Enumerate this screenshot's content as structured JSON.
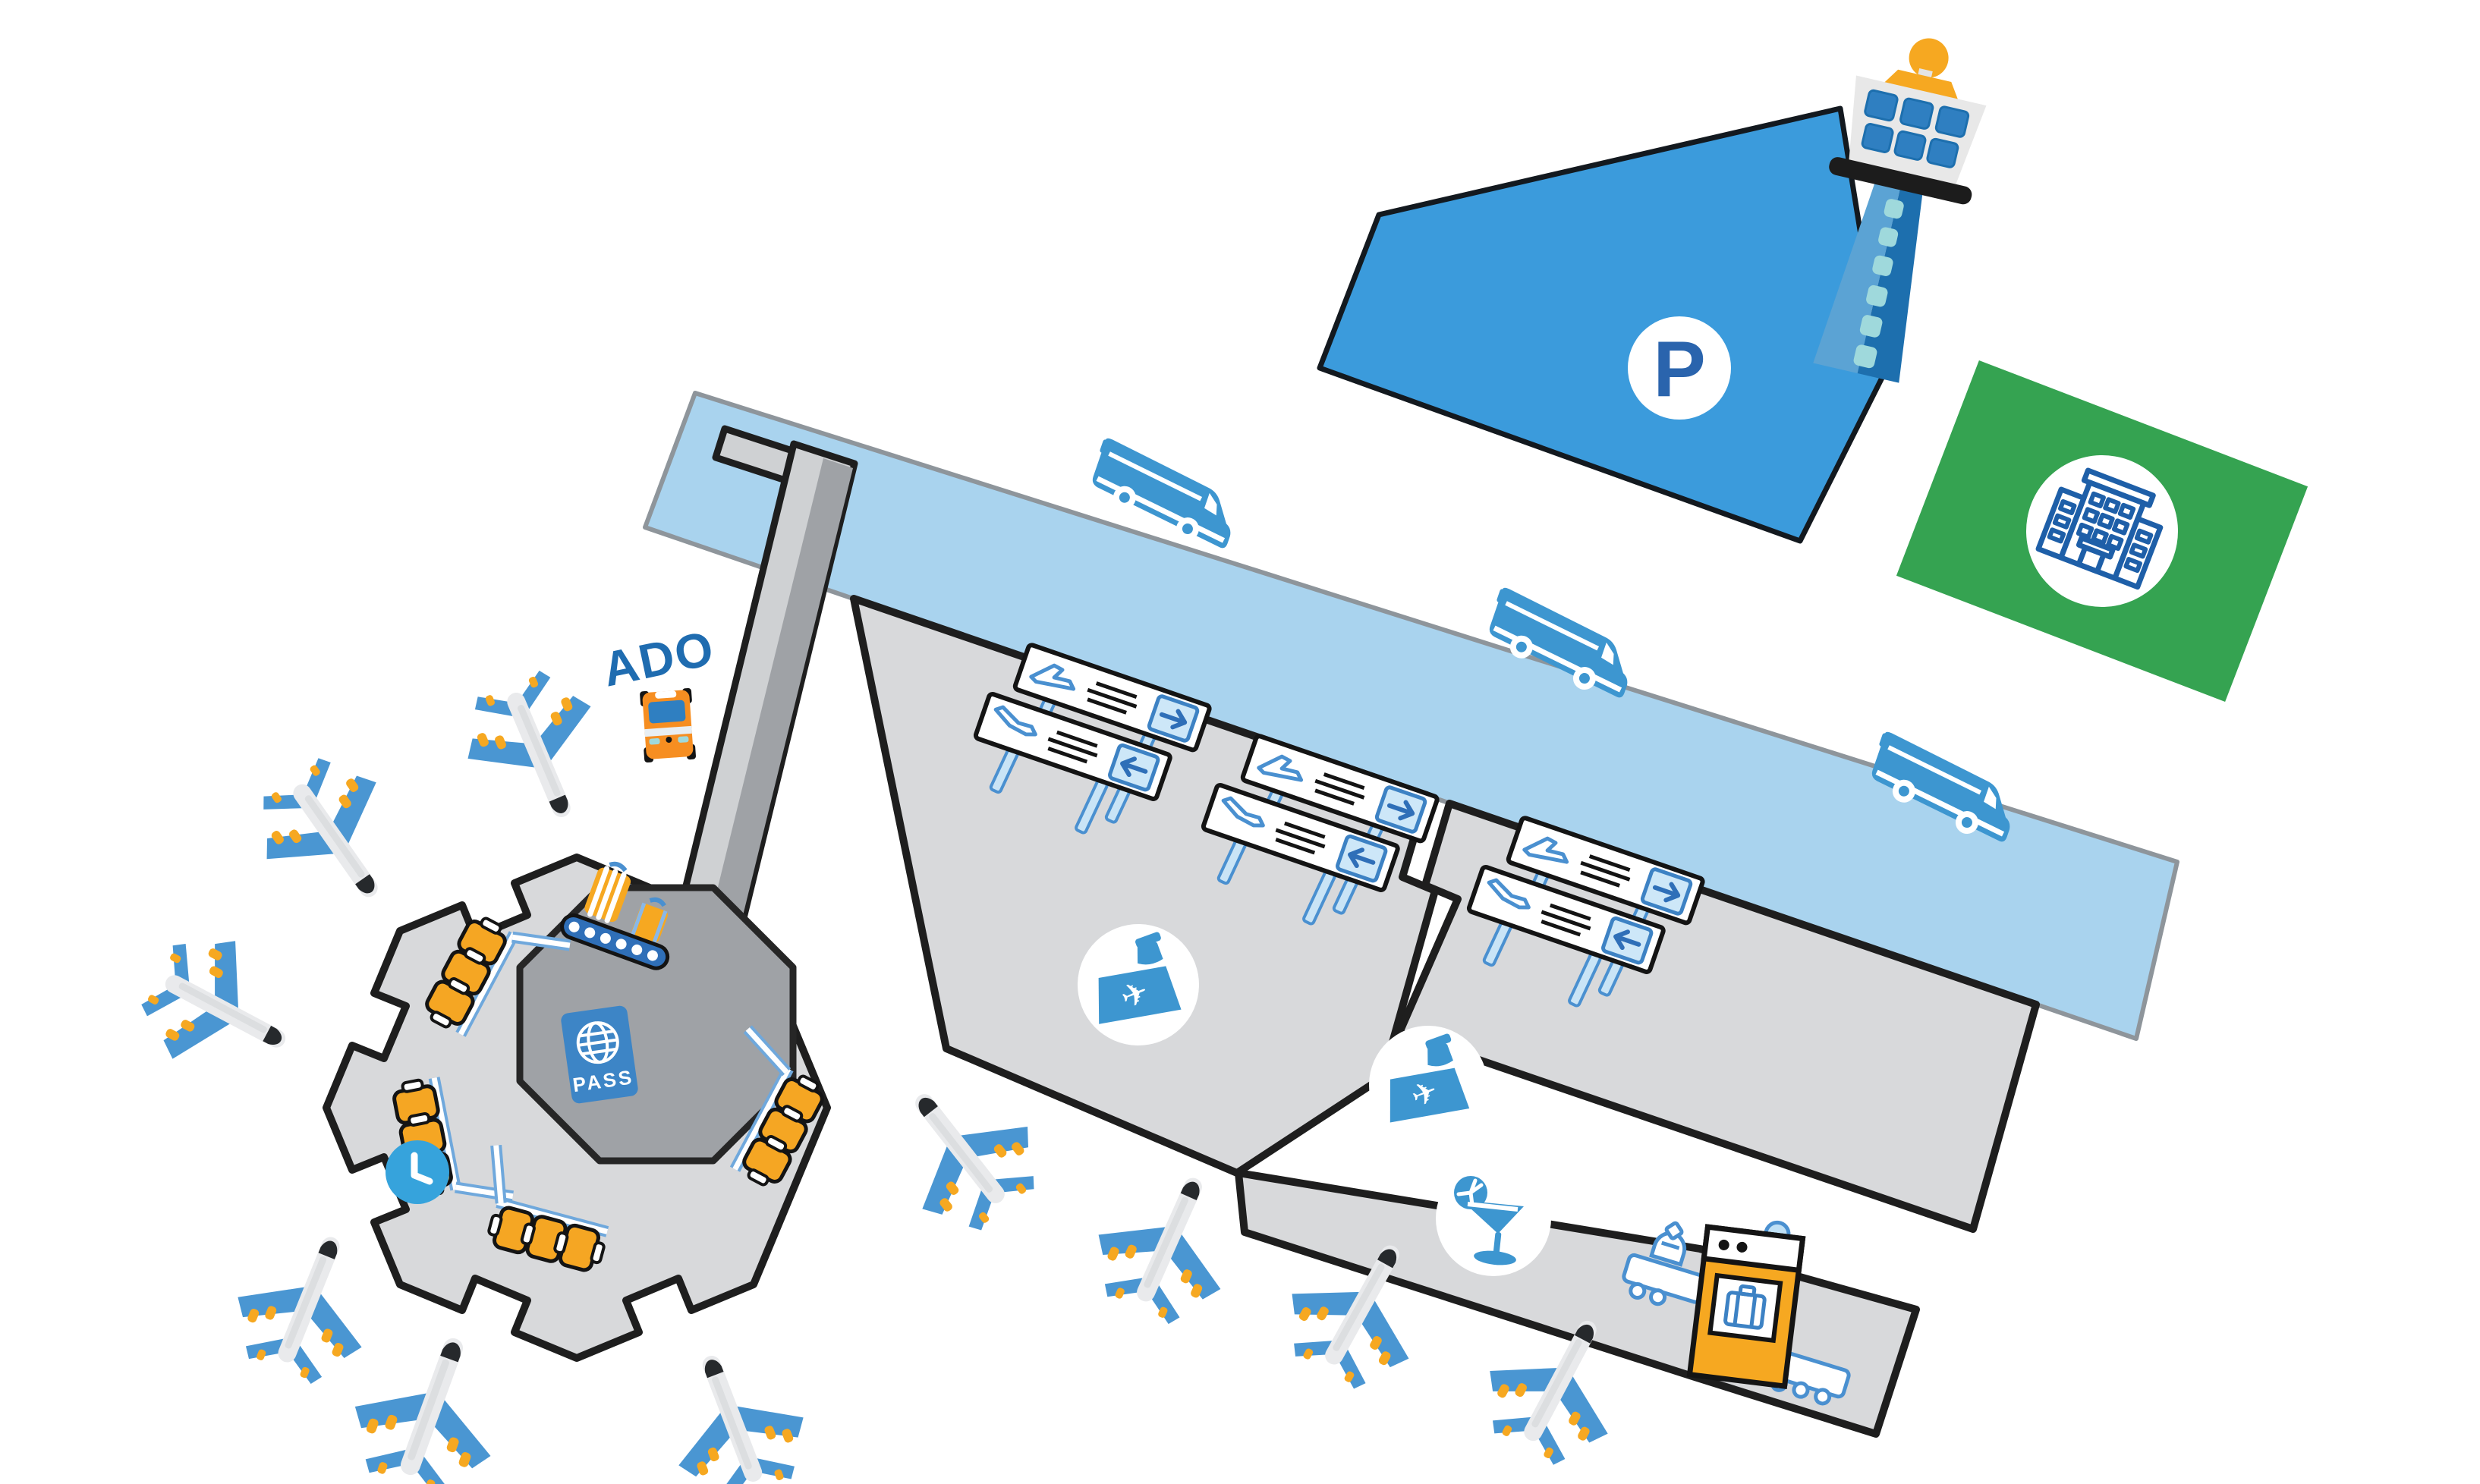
{
  "map": {
    "type": "airport-terminal-map",
    "labels": {
      "bus_stop": "ADO",
      "parking": "P",
      "passport": "PASS"
    },
    "colors": {
      "background": "#ffffff",
      "access_road": "#A9D3EE",
      "road_border": "#8E959B",
      "parking_lot": "#3B9BDC",
      "outline_black": "#1E1E1E",
      "terminal_gray": "#D8D9DB",
      "pier_gray": "#CFD1D3",
      "immigration_gray": "#9FA2A6",
      "hotel_zone_green": "#35A351",
      "icon_blue": "#3D96D0",
      "wing_blue": "#4A96D2",
      "accent_orange": "#F6A821",
      "seat_orange": "#F5A623",
      "label_blue": "#1F6CB0",
      "post_blue_fill": "#C9E4F6",
      "teal": "#9FD9DC"
    },
    "areas": [
      {
        "name": "parking-lot",
        "label": "P"
      },
      {
        "name": "control-tower"
      },
      {
        "name": "hotel-zone"
      },
      {
        "name": "access-road"
      },
      {
        "name": "main-terminal"
      },
      {
        "name": "secondary-terminal"
      },
      {
        "name": "services-concourse"
      },
      {
        "name": "pier-walkway"
      },
      {
        "name": "satellite-terminal"
      },
      {
        "name": "immigration-hall"
      }
    ],
    "facility_icons": [
      "control-tower-icon",
      "hotel-building-icon",
      "parking-icon",
      "shuttle-van-icon",
      "bus-icon",
      "departures-sign-icon",
      "arrivals-sign-icon",
      "check-in-desk-icon",
      "bar-icon",
      "security-scanner-icon",
      "baggage-carousel-icon",
      "passport-icon",
      "clock-icon",
      "gate-seats-icon",
      "airplane-icon"
    ],
    "counts": {
      "airplanes": 10,
      "shuttle_vans": 3,
      "sign_pairs": 3,
      "check_in_desks": 2,
      "gates": 4
    }
  }
}
